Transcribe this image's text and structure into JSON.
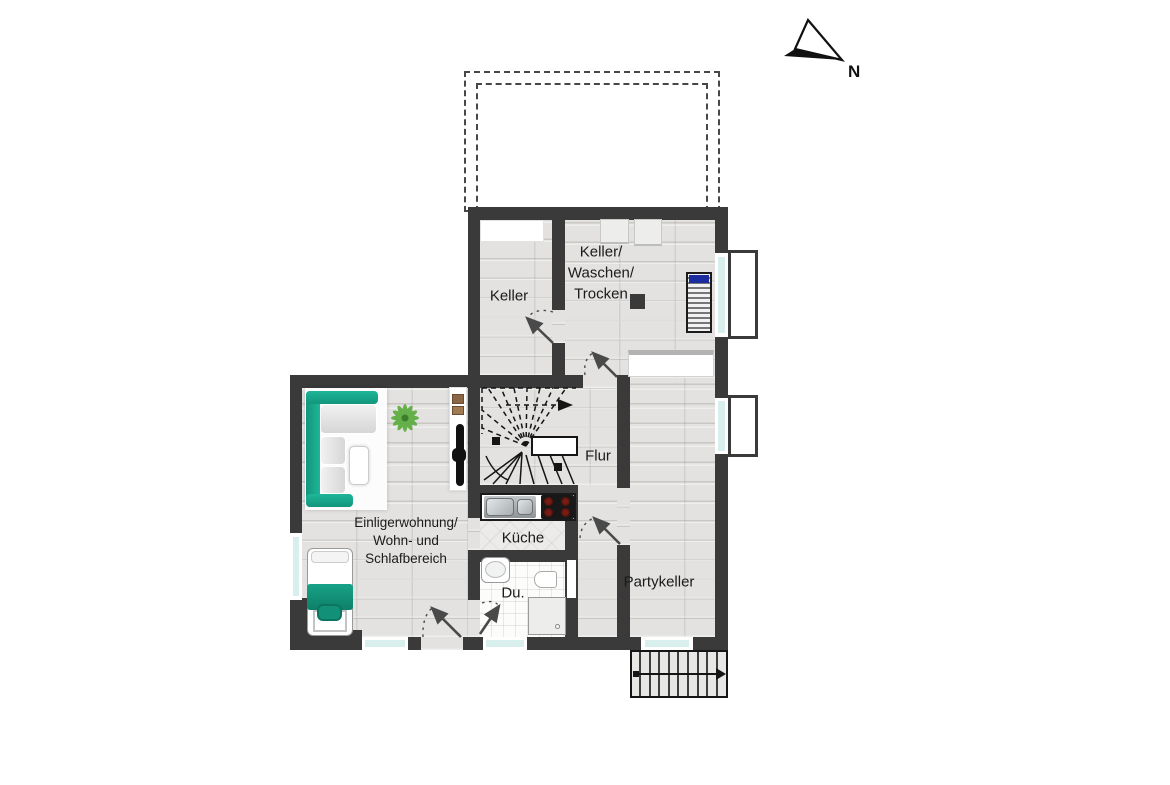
{
  "labels": {
    "keller": "Keller",
    "laundry_line1": "Keller/",
    "laundry_line2": "Waschen/",
    "laundry_line3": "Trocken",
    "flur": "Flur",
    "kueche": "Küche",
    "du": "Du.",
    "apartment_line1": "Einligerwohnung/",
    "apartment_line2": "Wohn- und",
    "apartment_line3": "Schlafbereich",
    "partykeller": "Partykeller",
    "north": "N"
  },
  "colors": {
    "wall": "#3a3a3a",
    "floor": "#e3e2e0",
    "accent_teal": "#14997e",
    "window_glass": "#d9efee",
    "washer_blue": "#1b2d9e",
    "burner_red": "#5a1712",
    "plant_green": "#5fae43"
  },
  "icons": {
    "compass": "north-arrow-icon"
  }
}
